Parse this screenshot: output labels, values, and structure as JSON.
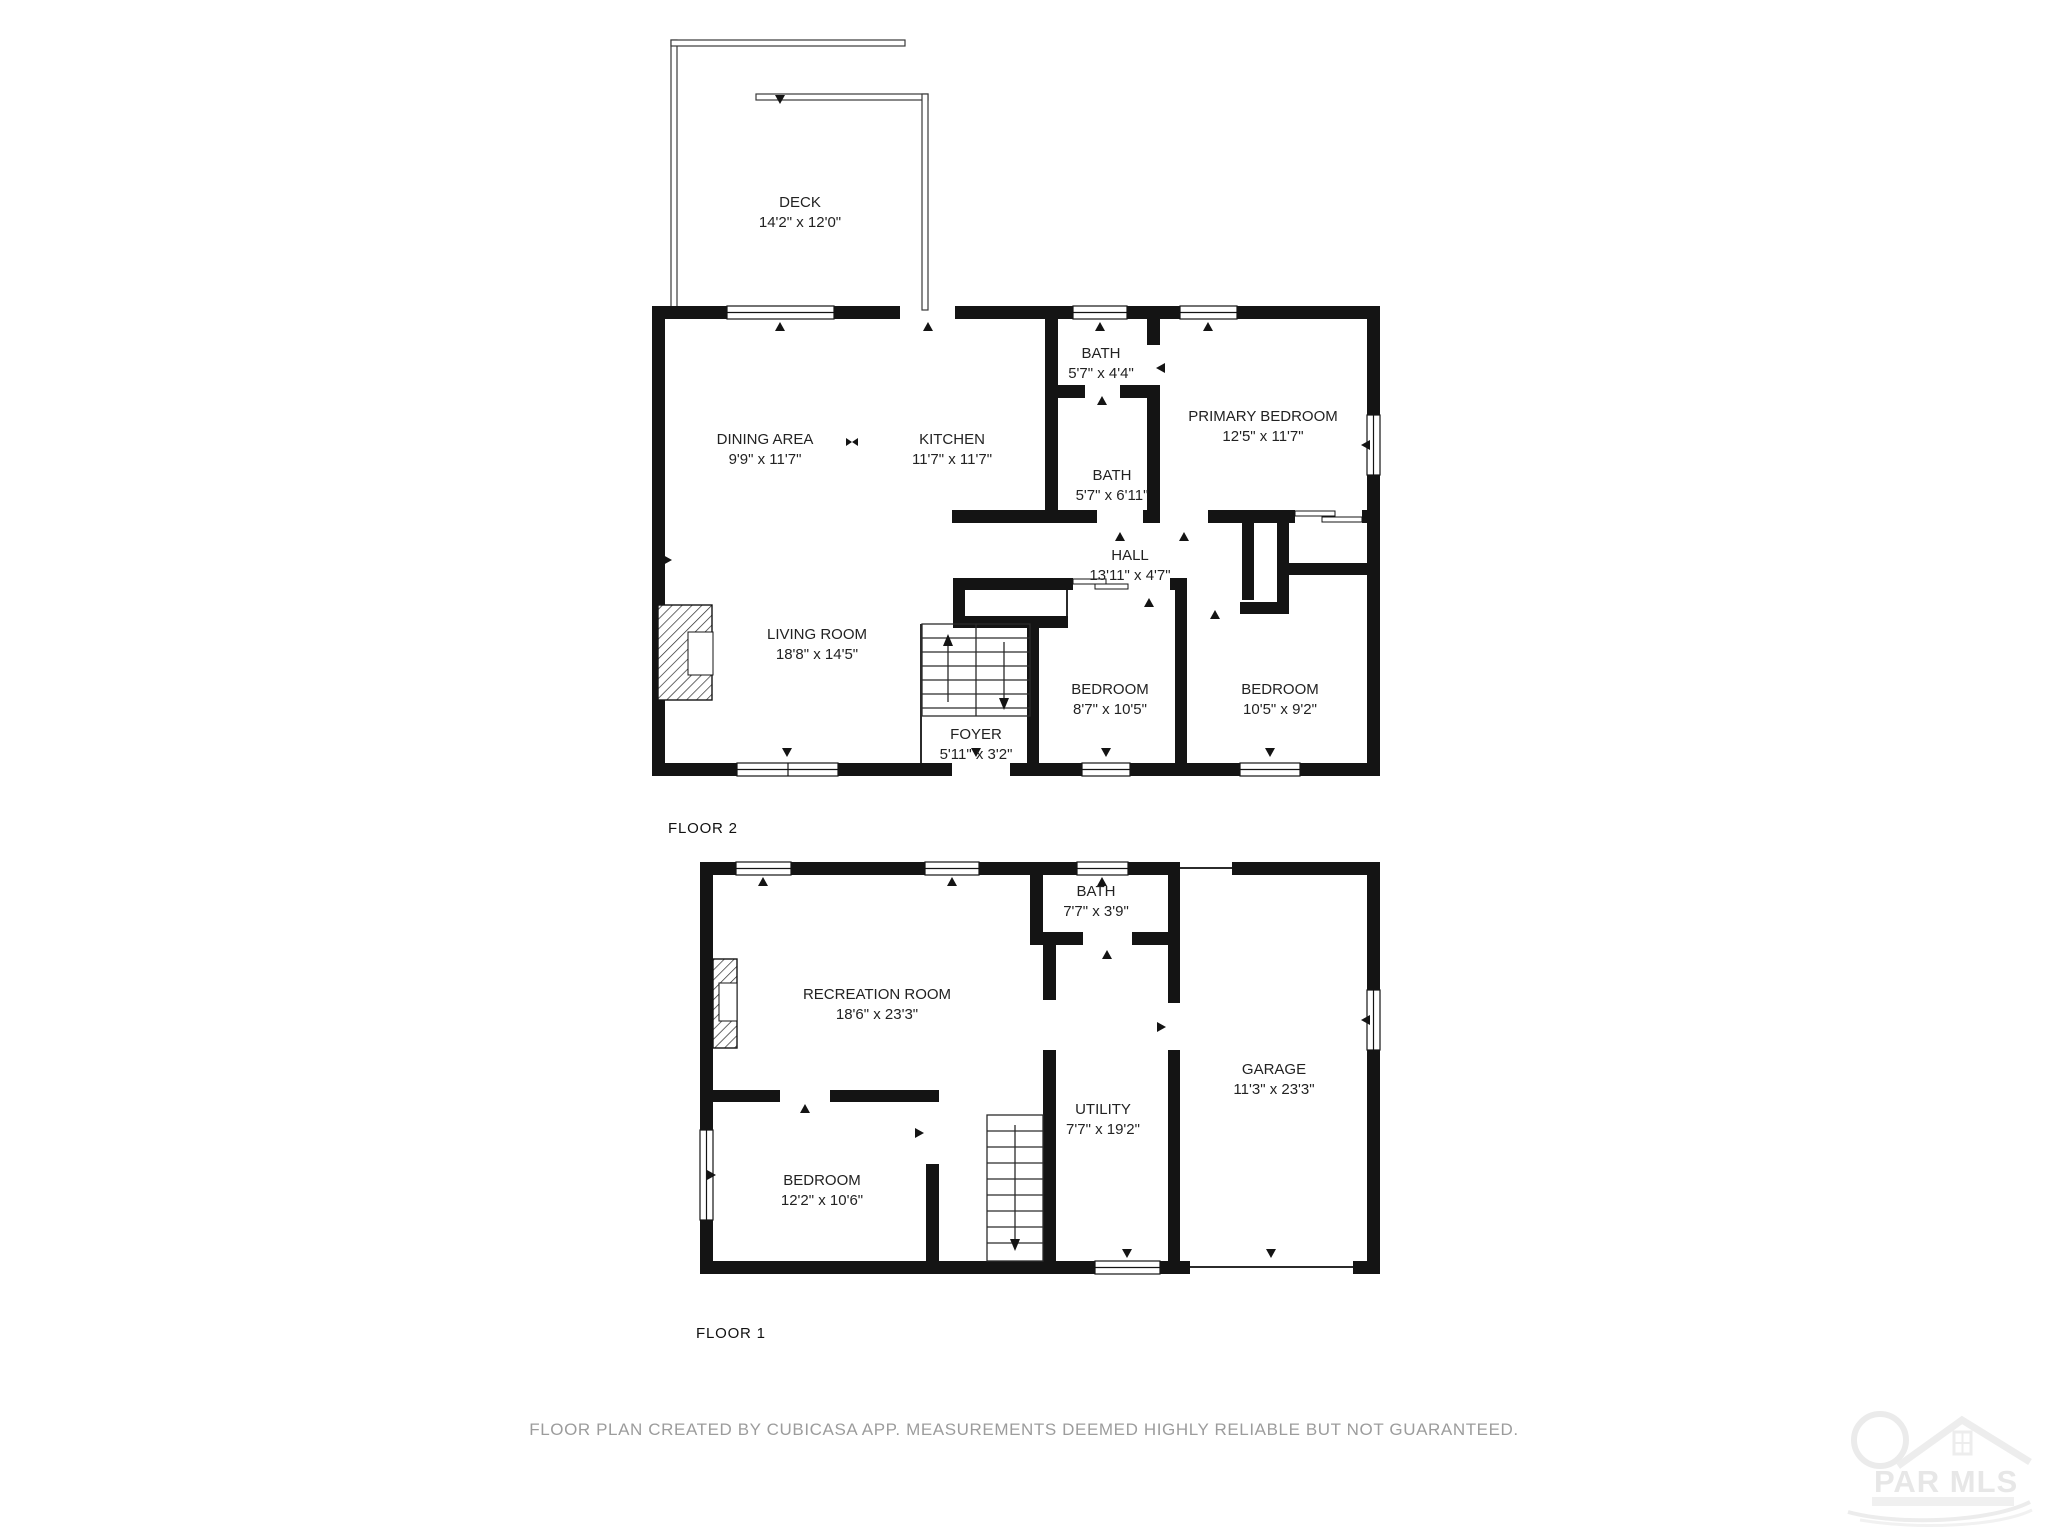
{
  "page": {
    "background": "#ffffff",
    "line_color": "#141414",
    "footer_color": "#9c9c9c"
  },
  "floors": [
    {
      "label": "FLOOR 2",
      "rooms": [
        {
          "name": "DECK",
          "dims": "14'2\" x 12'0\""
        },
        {
          "name": "DINING AREA",
          "dims": "9'9\" x 11'7\""
        },
        {
          "name": "KITCHEN",
          "dims": "11'7\" x 11'7\""
        },
        {
          "name": "BATH",
          "dims": "5'7\" x 4'4\""
        },
        {
          "name": "PRIMARY BEDROOM",
          "dims": "12'5\" x 11'7\""
        },
        {
          "name": "BATH",
          "dims": "5'7\" x 6'11\""
        },
        {
          "name": "HALL",
          "dims": "13'11\" x 4'7\""
        },
        {
          "name": "LIVING ROOM",
          "dims": "18'8\" x 14'5\""
        },
        {
          "name": "FOYER",
          "dims": "5'11\" x 3'2\""
        },
        {
          "name": "BEDROOM",
          "dims": "8'7\" x 10'5\""
        },
        {
          "name": "BEDROOM",
          "dims": "10'5\" x 9'2\""
        }
      ]
    },
    {
      "label": "FLOOR 1",
      "rooms": [
        {
          "name": "BATH",
          "dims": "7'7\" x 3'9\""
        },
        {
          "name": "RECREATION ROOM",
          "dims": "18'6\" x 23'3\""
        },
        {
          "name": "UTILITY",
          "dims": "7'7\" x 19'2\""
        },
        {
          "name": "GARAGE",
          "dims": "11'3\" x 23'3\""
        },
        {
          "name": "BEDROOM",
          "dims": "12'2\" x 10'6\""
        }
      ]
    }
  ],
  "footer": "FLOOR PLAN CREATED BY CUBICASA APP. MEASUREMENTS DEEMED HIGHLY RELIABLE BUT NOT GUARANTEED.",
  "watermark": {
    "text": "PAR MLS"
  }
}
